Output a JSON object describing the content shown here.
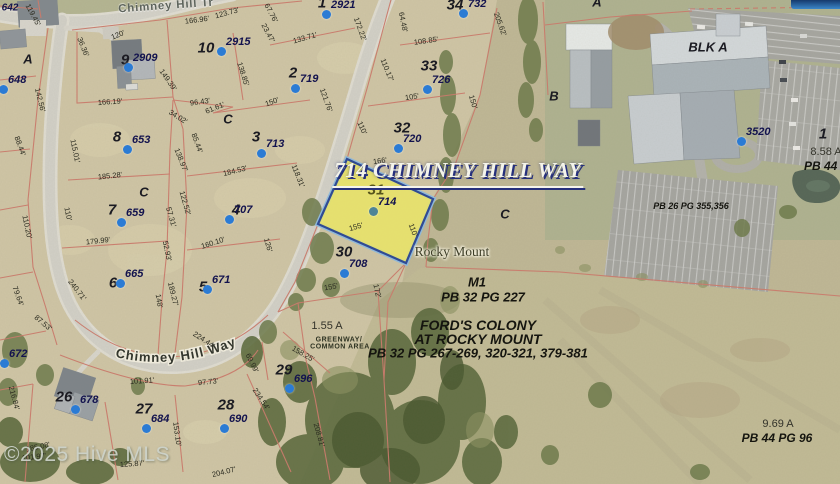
{
  "colors": {
    "highlight_fill": "#e9e468",
    "highlight_border": "#243d8b",
    "highlight_border_outer": "#8fb8d8",
    "dot_blue": "#2b7bd4",
    "dot_teal": "#4e8496",
    "lot_line_red": "#c97b6c",
    "title_navy": "#26307c"
  },
  "title": {
    "text": "714 CHIMNEY HILL WAY"
  },
  "watermark": {
    "text": "©2025 Hive MLS"
  },
  "streets": {
    "tr": "Chimney Hill Tr",
    "way": "Chimney Hill Way"
  },
  "city_label": {
    "text": "Rocky Mount"
  },
  "lots": [
    {
      "n": "1",
      "x": 322,
      "y": 3
    },
    {
      "n": "2",
      "x": 293,
      "y": 73
    },
    {
      "n": "3",
      "x": 256,
      "y": 137
    },
    {
      "n": "4",
      "x": 236,
      "y": 210
    },
    {
      "n": "5",
      "x": 203,
      "y": 287
    },
    {
      "n": "6",
      "x": 113,
      "y": 283
    },
    {
      "n": "7",
      "x": 112,
      "y": 210
    },
    {
      "n": "8",
      "x": 117,
      "y": 137
    },
    {
      "n": "9",
      "x": 125,
      "y": 60
    },
    {
      "n": "10",
      "x": 206,
      "y": 48
    },
    {
      "n": "26",
      "x": 64,
      "y": 397
    },
    {
      "n": "27",
      "x": 144,
      "y": 409
    },
    {
      "n": "28",
      "x": 226,
      "y": 405
    },
    {
      "n": "29",
      "x": 284,
      "y": 370
    },
    {
      "n": "30",
      "x": 344,
      "y": 252
    },
    {
      "n": "31",
      "x": 376,
      "y": 190,
      "hl": true
    },
    {
      "n": "32",
      "x": 402,
      "y": 128
    },
    {
      "n": "33",
      "x": 429,
      "y": 66
    },
    {
      "n": "34",
      "x": 455,
      "y": 5
    },
    {
      "n": "1",
      "x": 823,
      "y": 134
    }
  ],
  "letters": [
    {
      "t": "A",
      "x": 28,
      "y": 59
    },
    {
      "t": "A",
      "x": 597,
      "y": 2
    },
    {
      "t": "B",
      "x": 554,
      "y": 96
    },
    {
      "t": "C",
      "x": 228,
      "y": 119
    },
    {
      "t": "C",
      "x": 144,
      "y": 192
    },
    {
      "t": "C",
      "x": 505,
      "y": 214
    },
    {
      "t": "BLK A",
      "x": 708,
      "y": 47
    }
  ],
  "houses": [
    {
      "n": "2909",
      "x": 128,
      "y": 67
    },
    {
      "n": "2915",
      "x": 221,
      "y": 51
    },
    {
      "n": "2921",
      "x": 326,
      "y": 14
    },
    {
      "n": "732",
      "x": 463,
      "y": 13
    },
    {
      "n": "719",
      "x": 295,
      "y": 88
    },
    {
      "n": "726",
      "x": 427,
      "y": 89
    },
    {
      "n": "720",
      "x": 398,
      "y": 148
    },
    {
      "n": "653",
      "x": 127,
      "y": 149
    },
    {
      "n": "713",
      "x": 261,
      "y": 153
    },
    {
      "n": "707",
      "x": 229,
      "y": 219
    },
    {
      "n": "659",
      "x": 121,
      "y": 222
    },
    {
      "n": "665",
      "x": 120,
      "y": 283
    },
    {
      "n": "671",
      "x": 207,
      "y": 289
    },
    {
      "n": "648",
      "x": 3,
      "y": 89
    },
    {
      "n": "672",
      "x": 4,
      "y": 363
    },
    {
      "n": "678",
      "x": 75,
      "y": 409
    },
    {
      "n": "684",
      "x": 146,
      "y": 428
    },
    {
      "n": "690",
      "x": 224,
      "y": 428
    },
    {
      "n": "696",
      "x": 289,
      "y": 388
    },
    {
      "n": "708",
      "x": 344,
      "y": 273
    },
    {
      "n": "714",
      "x": 373,
      "y": 211,
      "teal": true
    },
    {
      "n": "3520",
      "x": 741,
      "y": 141
    }
  ],
  "dimensions": [
    [
      "119.45'",
      33,
      15,
      62
    ],
    [
      "166.96'",
      197,
      20,
      -7
    ],
    [
      "120'",
      118,
      35,
      -22
    ],
    [
      "36.36'",
      83,
      47,
      68
    ],
    [
      "123.73'",
      227,
      13,
      -15
    ],
    [
      "23.47'",
      268,
      33,
      62
    ],
    [
      "67.76'",
      271,
      13,
      62
    ],
    [
      "133.71'",
      305,
      38,
      -16
    ],
    [
      "172.22'",
      360,
      29,
      70
    ],
    [
      "64.48'",
      403,
      22,
      78
    ],
    [
      "108.85'",
      426,
      41,
      -8
    ],
    [
      "110.17'",
      387,
      70,
      68
    ],
    [
      "138.85'",
      243,
      74,
      72
    ],
    [
      "149.39'",
      168,
      80,
      55
    ],
    [
      "166.19'",
      110,
      102,
      -4
    ],
    [
      "142.56'",
      40,
      100,
      76
    ],
    [
      "96.43'",
      200,
      102,
      -8
    ],
    [
      "61.61'",
      215,
      108,
      -22
    ],
    [
      "34.02'",
      178,
      117,
      32
    ],
    [
      "150'",
      272,
      102,
      -20
    ],
    [
      "121.76'",
      326,
      100,
      70
    ],
    [
      "105'",
      412,
      97,
      -8
    ],
    [
      "150'",
      473,
      102,
      74
    ],
    [
      "110'",
      362,
      128,
      66
    ],
    [
      "205.62'",
      500,
      24,
      70
    ],
    [
      "185.28'",
      110,
      176,
      -6
    ],
    [
      "138.97'",
      181,
      160,
      68
    ],
    [
      "184.53'",
      235,
      171,
      -14
    ],
    [
      "118.31'",
      298,
      176,
      68
    ],
    [
      "115.01'",
      75,
      151,
      78
    ],
    [
      "85.44'",
      197,
      143,
      70
    ],
    [
      "88.44'",
      20,
      146,
      70
    ],
    [
      "110.20'",
      27,
      227,
      78
    ],
    [
      "122.52'",
      185,
      203,
      74
    ],
    [
      "57.31'",
      171,
      217,
      74
    ],
    [
      "179.99'",
      98,
      241,
      -6
    ],
    [
      "160.10'",
      213,
      243,
      -18
    ],
    [
      "52.93'",
      167,
      251,
      78
    ],
    [
      "126'",
      268,
      245,
      74
    ],
    [
      "110'",
      68,
      214,
      78
    ],
    [
      "166'",
      380,
      161,
      -8
    ],
    [
      "155'",
      356,
      227,
      -16
    ],
    [
      "110'",
      413,
      230,
      70
    ],
    [
      "79.64'",
      18,
      296,
      70
    ],
    [
      "240.71'",
      77,
      290,
      52
    ],
    [
      "87.53'",
      43,
      323,
      40
    ],
    [
      "148'",
      159,
      301,
      80
    ],
    [
      "189.27'",
      173,
      294,
      76
    ],
    [
      "155'",
      331,
      287,
      -10
    ],
    [
      "172'",
      377,
      291,
      78
    ],
    [
      "224.44'",
      204,
      340,
      33
    ],
    [
      "158.25'",
      303,
      354,
      30
    ],
    [
      "69.99'",
      252,
      363,
      64
    ],
    [
      "101.91'",
      142,
      381,
      -4
    ],
    [
      "97.73'",
      208,
      382,
      -6
    ],
    [
      "234.54'",
      261,
      399,
      56
    ],
    [
      "216.84'",
      14,
      398,
      75
    ],
    [
      "153.10'",
      177,
      434,
      82
    ],
    [
      "208.81'",
      319,
      435,
      74
    ],
    [
      "185.08'",
      38,
      447,
      -12
    ],
    [
      "101.97'",
      34,
      457,
      -6
    ],
    [
      "125.87'",
      132,
      464,
      -4
    ],
    [
      "204.07'",
      224,
      472,
      -14
    ]
  ],
  "areas": [
    {
      "t": "M1",
      "x": 477,
      "y": 282,
      "s": "bi13"
    },
    {
      "t": "PB 32  PG 227",
      "x": 483,
      "y": 297,
      "s": "bi13"
    },
    {
      "t": "FORD'S COLONY",
      "x": 478,
      "y": 325,
      "s": "bi14"
    },
    {
      "t": "AT ROCKY MOUNT",
      "x": 478,
      "y": 339,
      "s": "bi14"
    },
    {
      "t": "PB 32  PG 267-269, 320-321, 379-381",
      "x": 478,
      "y": 353,
      "s": "bi13"
    },
    {
      "t": "PB 26  PG 355,356",
      "x": 691,
      "y": 206,
      "s": "bi9"
    },
    {
      "t": "8.58 A",
      "x": 826,
      "y": 152,
      "s": "r11"
    },
    {
      "t": "PB 44  PG",
      "x": 831,
      "y": 166,
      "s": "bi12"
    },
    {
      "t": "9.69 A",
      "x": 778,
      "y": 424,
      "s": "r11"
    },
    {
      "t": "PB 44  PG 96",
      "x": 777,
      "y": 438,
      "s": "bi12"
    },
    {
      "t": "1.55 A",
      "x": 327,
      "y": 326,
      "s": "r11"
    },
    {
      "t": "GREENWAY/",
      "x": 339,
      "y": 340,
      "s": "g7"
    },
    {
      "t": "COMMON AREA",
      "x": 340,
      "y": 347,
      "s": "g7"
    },
    {
      "t": "642",
      "x": 10,
      "y": 8,
      "s": "nv10"
    }
  ]
}
